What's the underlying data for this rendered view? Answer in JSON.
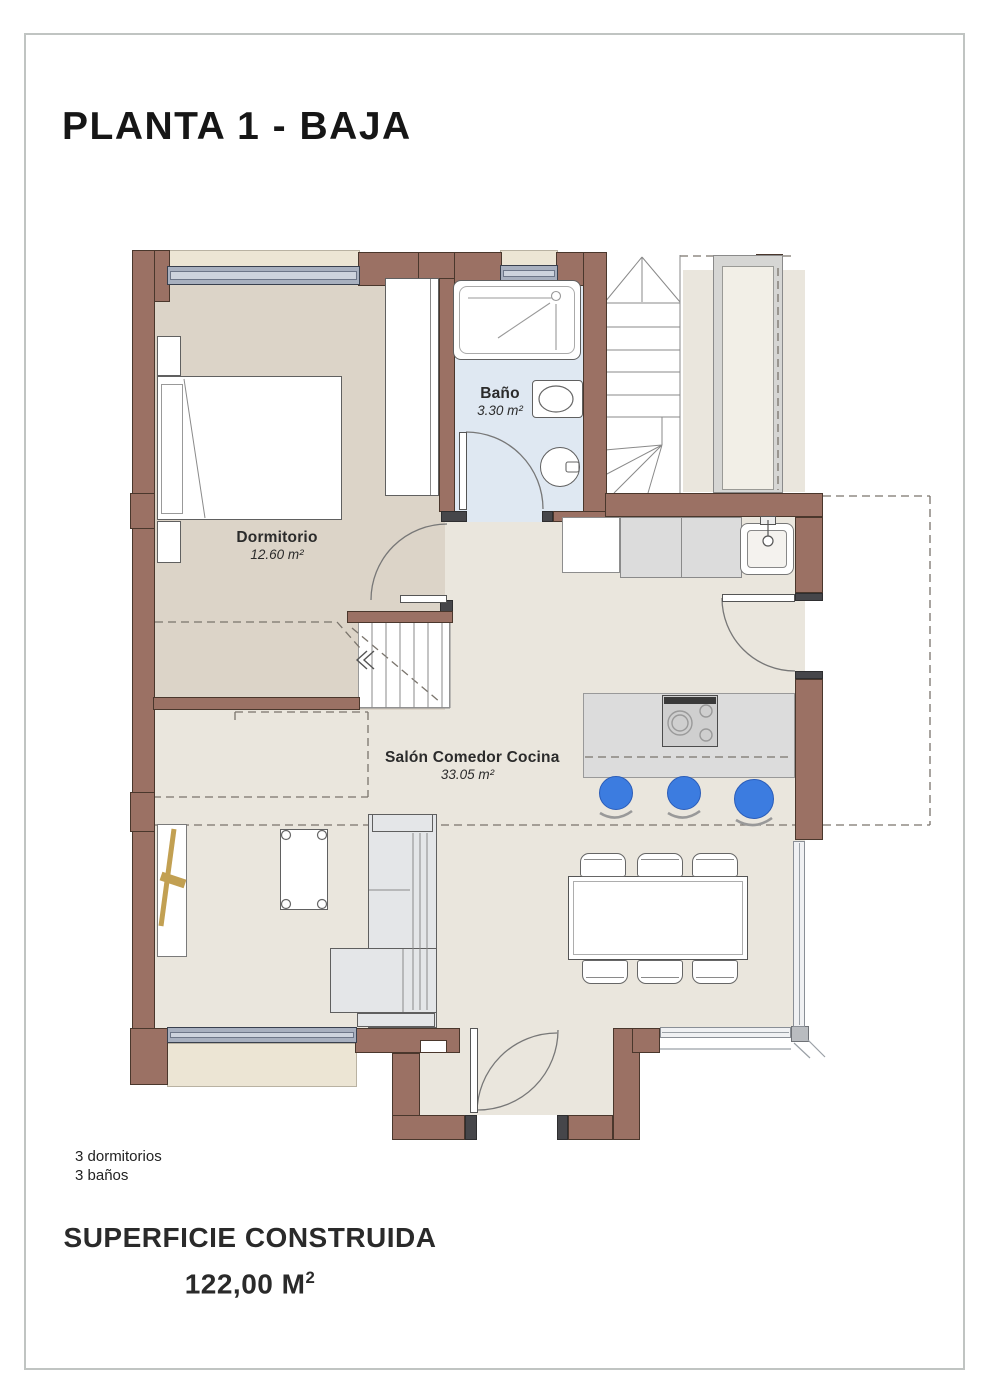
{
  "title": "PLANTA 1 - BAJA",
  "rooms": {
    "bedroom": {
      "name": "Dormitorio",
      "area": "12.60 m²"
    },
    "bathroom": {
      "name": "Baño",
      "area": "3.30 m²"
    },
    "living": {
      "name": "Salón Comedor Cocina",
      "area": "33.05 m²"
    }
  },
  "summary": {
    "bedrooms": "3 dormitorios",
    "bathrooms": "3 baños"
  },
  "footer": {
    "label": "SUPERFICIE CONSTRUIDA",
    "value": "122,00 M",
    "value_sup": "2"
  },
  "colors": {
    "wall": "#9b7164",
    "wall_outline": "#4a372c",
    "jamb": "#46464a",
    "floor_living": "#eae6dd",
    "floor_bedroom": "#dcd4c8",
    "floor_bath": "#dfe8f2",
    "sill": "#ece5d4",
    "counter": "#dcdcdc",
    "stool": "#3c7ce0",
    "wood": "#c2a052",
    "page_border": "#c0c4c2",
    "dashed_line": "#7a746c"
  }
}
